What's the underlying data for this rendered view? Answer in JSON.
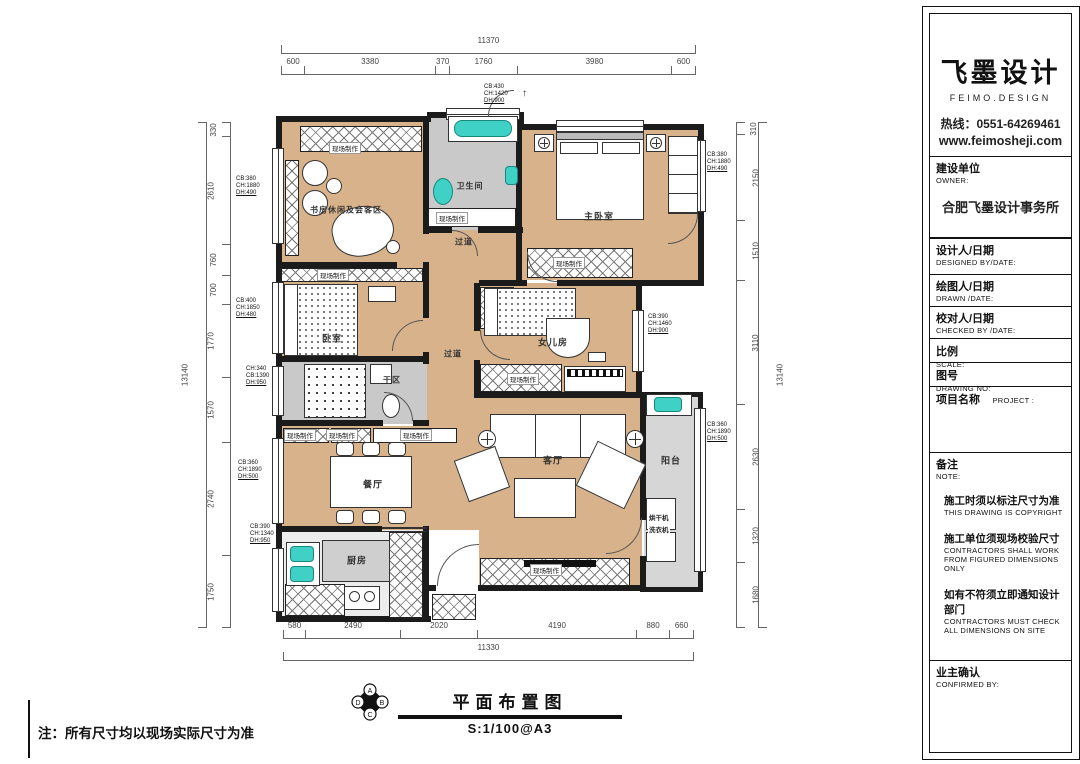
{
  "sheet_note": "注：所有尺寸均以现场实际尺寸为准",
  "footer": {
    "drawing_title": "平面布置图",
    "scale": "S:1/100@A3",
    "compass": [
      "A",
      "B",
      "C",
      "D"
    ]
  },
  "title_block": {
    "brand_name": "飞墨设计",
    "brand_sub": "FEIMO.DESIGN",
    "hotline": "热线：0551-64269461",
    "website": "www.feimosheji.com",
    "owner_cn": "建设单位",
    "owner_en": "OWNER:",
    "owner_value": "合肥飞墨设计事务所",
    "designed_cn": "设计人/日期",
    "designed_en": "DESIGNED BY/DATE:",
    "drawn_cn": "绘图人/日期",
    "drawn_en": "DRAWN /DATE:",
    "checked_cn": "校对人/日期",
    "checked_en": "CHECKED BY /DATE:",
    "scale_cn": "比例",
    "scale_en": "SCALE:",
    "no_cn": "图号",
    "no_en": "DRAWING NO:",
    "project_cn": "项目名称",
    "project_en": "PROJECT :",
    "note_cn": "备注",
    "note_en": "NOTE:",
    "note1_cn": "施工时须以标注尺寸为准",
    "note1_en": "THIS DRAWING IS COPYRIGHT",
    "note2_cn": "施工单位须现场校验尺寸",
    "note2_en": "CONTRACTORS SHALL WORK\nFROM FIGURED DIMENSIONS\nONLY",
    "note3_cn": "如有不符须立即通知设计部门",
    "note3_en": "CONTRACTORS MUST CHECK\nALL DIMENSIONS ON SITE",
    "confirm_cn": "业主确认",
    "confirm_en": "CONFIRMED BY:"
  },
  "plan": {
    "rooms": {
      "study": "书房休闲及会客区",
      "bath": "卫生间",
      "master": "主卧室",
      "bedroom": "卧室",
      "drybath": "干区",
      "girl": "女儿房",
      "corridor": "过道",
      "dining": "餐厅",
      "living": "客厅",
      "kitchen": "厨房",
      "balcony": "阳台"
    },
    "cabinet_label": "现场制作",
    "dryer": "烘干机",
    "washer": "洗衣机",
    "window_tags": {
      "top": {
        "l1": "CB:430",
        "l2": "CH:1420",
        "l3": "DH:900"
      },
      "l1": {
        "l1": "CB:380",
        "l2": "CH:1880",
        "l3": "DH:490"
      },
      "l2": {
        "l1": "CB:400",
        "l2": "CH:1850",
        "l3": "DH:480"
      },
      "l3": {
        "l1": "CH:340",
        "l2": "CB:1390",
        "l3": "DH:950"
      },
      "l4": {
        "l1": "CB:360",
        "l2": "CH:1890",
        "l3": "DH:500"
      },
      "l5": {
        "l1": "CB:390",
        "l2": "CH:1340",
        "l3": "DH:950"
      },
      "r1": {
        "l1": "CB:380",
        "l2": "CH:1880",
        "l3": "DH:490"
      },
      "r2": {
        "l1": "CB:390",
        "l2": "CH:1460",
        "l3": "DH:900"
      },
      "r3": {
        "l1": "CB:360",
        "l2": "CH:1890",
        "l3": "DH:500"
      }
    },
    "dims_top": {
      "overall": "11370",
      "segments": [
        "600",
        "3380",
        "370",
        "1760",
        "3980",
        "600"
      ]
    },
    "dims_bottom": {
      "overall": "11330",
      "segments": [
        "580",
        "2490",
        "2020",
        "4190",
        "880",
        "660"
      ]
    },
    "dims_left": {
      "overall": "13140",
      "segments": [
        "330",
        "2610",
        "760",
        "700",
        "1770",
        "1570",
        "2740",
        "1750"
      ]
    },
    "dims_right": {
      "overall": "13140",
      "segments": [
        "310",
        "2150",
        "1510",
        "3110",
        "2630",
        "1320",
        "1680"
      ]
    }
  }
}
